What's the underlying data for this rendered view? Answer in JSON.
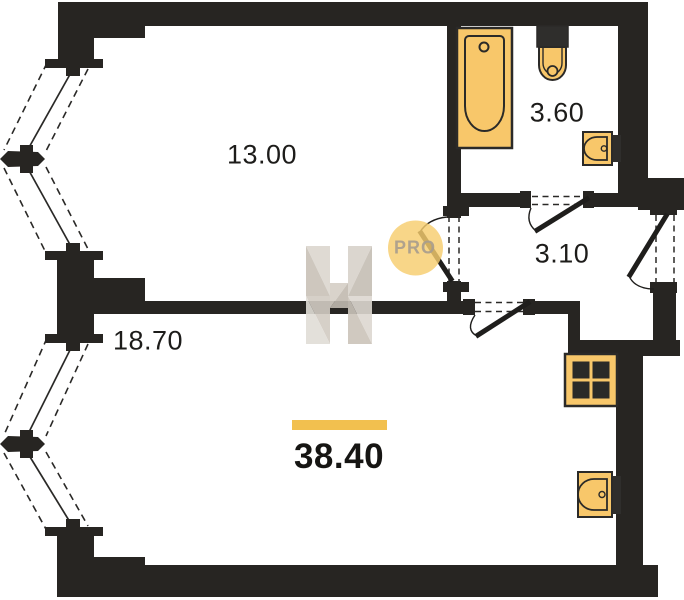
{
  "plan": {
    "total_area": "38.40",
    "rooms": [
      {
        "id": "room-top",
        "area": "13.00"
      },
      {
        "id": "room-bottom",
        "area": "18.70"
      },
      {
        "id": "bathroom",
        "area": "3.60"
      },
      {
        "id": "hallway",
        "area": "3.10"
      }
    ],
    "fixtures": [
      "bathtub",
      "toilet",
      "wash-basin",
      "stove",
      "kitchen-sink"
    ],
    "colors": {
      "wall": "#272522",
      "fixture_fill": "#f8c76a",
      "fixture_stroke": "#2b2a28",
      "accent_bar": "#f2c04f",
      "watermark_circle": "#f6cd6e",
      "watermark_text": "#a89d8e"
    }
  },
  "watermark": {
    "label": "PRO"
  }
}
